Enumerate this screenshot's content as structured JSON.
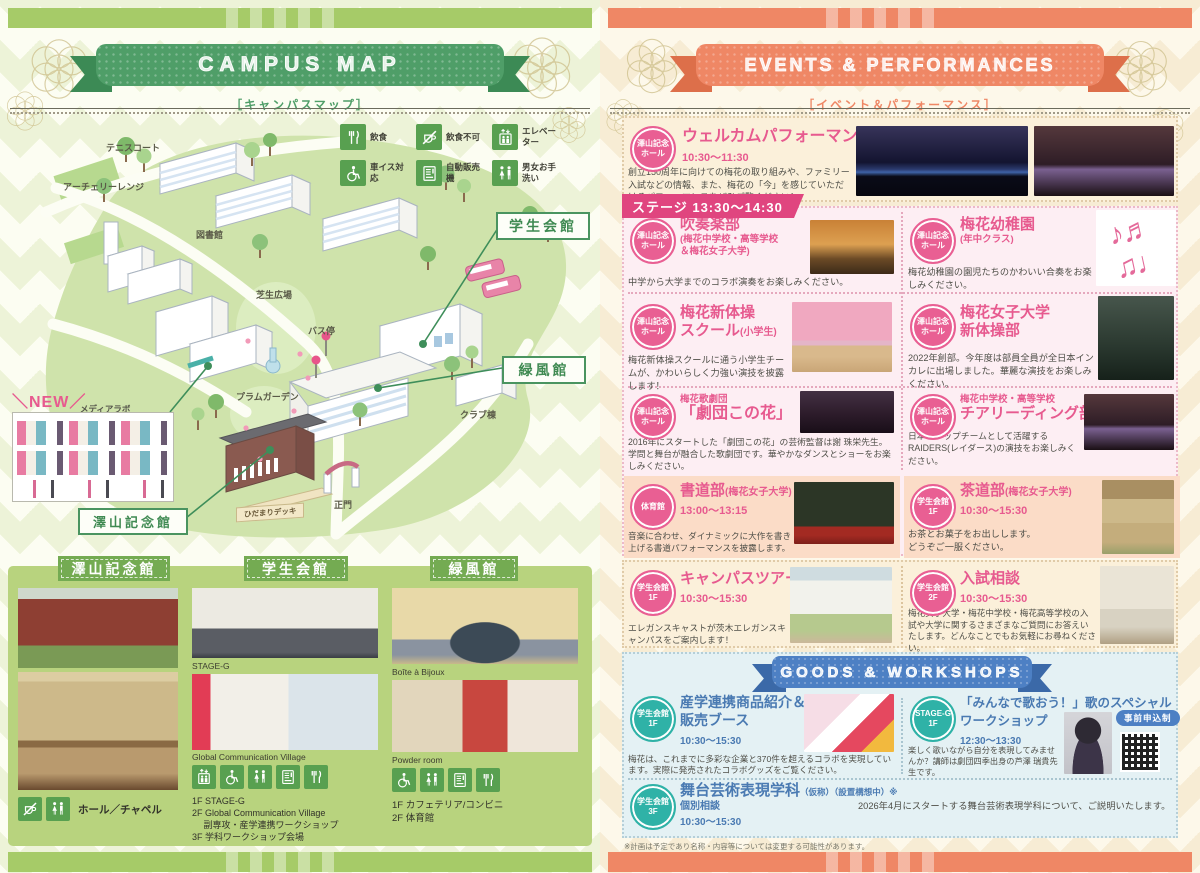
{
  "left_page": {
    "ribbon": {
      "title": "CAMPUS MAP",
      "subtitle": "［キャンパスマップ］"
    },
    "legend": {
      "items": [
        {
          "icon": "utensils-icon",
          "label": "飲食"
        },
        {
          "icon": "no-food-icon",
          "label": "飲食不可"
        },
        {
          "icon": "elevator-icon",
          "label": "エレベーター"
        },
        {
          "icon": "wheelchair-icon",
          "label": "車イス対応"
        },
        {
          "icon": "vending-icon",
          "label": "自動販売機"
        },
        {
          "icon": "restroom-icon",
          "label": "男女お手洗い"
        }
      ]
    },
    "map": {
      "labels": {
        "tennis_court": "テニスコート",
        "archery_range": "アーチェリーレンジ",
        "library": "図書館",
        "lawn_plaza": "芝生広場",
        "new_tag": "＼NEW／",
        "media_lab": "メディアラボ",
        "plum_garden": "プラムガーデン",
        "bus_stop": "バス停",
        "student_hall": "学生会館",
        "ryokufu_hall": "緑風館",
        "club_building": "クラブ棟",
        "main_gate": "正門",
        "hidamari_deck": "ひだまりデッキ",
        "sawayama_hall": "澤山記念館"
      }
    },
    "buildings": {
      "columns": [
        {
          "title": "澤山記念館",
          "facility": "ホール／チャペル",
          "icons": [
            "no-food-icon",
            "restroom-icon"
          ],
          "captions": [],
          "floors": []
        },
        {
          "title": "学生会館",
          "captions": [
            "STAGE-G",
            "Global Communication Village"
          ],
          "icons": [
            "elevator-icon",
            "wheelchair-icon",
            "restroom-icon",
            "vending-icon",
            "utensils-icon"
          ],
          "floors": [
            "1F STAGE-G",
            "2F Global Communication Village",
            "　 副専攻・産学連携ワークショップ",
            "3F 学科ワークショップ会場"
          ]
        },
        {
          "title": "緑風館",
          "captions": [
            "Boîte à Bijoux",
            "Powder room"
          ],
          "icons": [
            "wheelchair-icon",
            "restroom-icon",
            "vending-icon",
            "utensils-icon"
          ],
          "floors": [
            "1F カフェテリア/コンビニ",
            "2F 体育館"
          ]
        }
      ]
    }
  },
  "right_page": {
    "ribbon": {
      "title": "EVENTS & PERFORMANCES",
      "subtitle": "［イベント＆パフォーマンス］"
    },
    "welcome": {
      "venue1": "澤山記念",
      "venue2": "ホール",
      "title": "ウェルカムパフォーマンス",
      "time": "10:30～11:30",
      "desc": "創立150周年に向けての梅花の取り組みや、ファミリー入試などの情報、また、梅花の「今」を感じていただけるパフォーマンスをぜひご覧ください！"
    },
    "stage": {
      "banner": "ステージ 13:30～14:30",
      "events": [
        {
          "venue1": "澤山記念",
          "venue2": "ホール",
          "title": "吹奏楽部",
          "sub": "(梅花中学校・高等学校\n＆梅花女子大学)",
          "desc": "中学から大学までのコラボ演奏をお楽しみください。"
        },
        {
          "venue1": "澤山記念",
          "venue2": "ホール",
          "title": "梅花幼稚園",
          "sub": "(年中クラス)",
          "desc": "梅花幼稚園の園児たちのかわいい合奏をお楽しみください。"
        },
        {
          "venue1": "澤山記念",
          "venue2": "ホール",
          "title": "梅花新体操\nスクール",
          "sub": "(小学生)",
          "desc": "梅花新体操スクールに通う小学生チームが、かわいらしく力強い演技を披露します！"
        },
        {
          "venue1": "澤山記念",
          "venue2": "ホール",
          "title": "梅花女子大学\n新体操部",
          "desc": "2022年創部。今年度は部員全員が全日本インカレに出場しました。華麗な演技をお楽しみください。"
        },
        {
          "venue1": "澤山記念",
          "venue2": "ホール",
          "pre": "梅花歌劇団",
          "title": "「劇団この花」",
          "desc": "2016年にスタートした「劇団この花」の芸術監督は謝 珠栄先生。学問と舞台が融合した歌劇団です。華やかなダンスとショーをお楽しみください。"
        },
        {
          "venue1": "澤山記念",
          "venue2": "ホール",
          "pre": "梅花中学校・高等学校",
          "title": "チアリーディング部",
          "desc": "日本のトップチームとして活躍するRAIDERS(レイダース)の演技をお楽しみください。"
        },
        {
          "venue1": "体育館",
          "venue2": "",
          "title": "書道部",
          "sub": "(梅花女子大学)",
          "time": "13:00～13:15",
          "desc": "音楽に合わせ、ダイナミックに大作を書き上げる書道パフォーマンスを披露します。"
        },
        {
          "venue1": "学生会館",
          "venue2": "1F",
          "title": "茶道部",
          "sub": "(梅花女子大学)",
          "time": "10:30～15:30",
          "desc": "お茶とお菓子をお出しします。\nどうぞご一服ください。"
        }
      ]
    },
    "tours": [
      {
        "venue1": "学生会館",
        "venue2": "1F",
        "title": "キャンパスツアー",
        "time": "10:30～15:30",
        "desc": "エレガンスキャストが茨木エレガンスキャンパスをご案内します！"
      },
      {
        "venue1": "学生会館",
        "venue2": "2F",
        "title": "入試相談",
        "time": "10:30～15:30",
        "desc": "梅花女子大学・梅花中学校・梅花高等学校の入試や大学に関するさまざまなご質問にお答えいたします。どんなことでもお気軽にお尋ねください。"
      }
    ],
    "goods": {
      "ribbon_title": "GOODS & WORKSHOPS",
      "events": [
        {
          "venue1": "学生会館",
          "venue2": "1F",
          "title": "産学連携商品紹介＆\n販売ブース",
          "time": "10:30～15:30",
          "desc": "梅花は、これまでに多彩な企業と370件を超えるコラボを実現しています。実際に発売されたコラボグッズをご覧ください。"
        },
        {
          "venue1": "STAGE-G",
          "venue2": "1F",
          "title": "「みんなで歌おう！」歌のスペシャル\nワークショップ",
          "time": "12:30～13:30",
          "badge": "事前申込制",
          "desc": "楽しく歌いながら自分を表現してみませんか？講師は劇団四季出身の芦澤 瑞貴先生です。"
        }
      ],
      "bottom": {
        "venue1": "学生会館",
        "venue2": "3F",
        "title": "舞台芸術表現学科",
        "title_note": "（仮称）（設置構想中）※",
        "line2": "個別相談",
        "time": "10:30～15:30",
        "desc": "2026年4月にスタートする舞台芸術表現学科について、ご説明いたします。"
      }
    },
    "note": "※計画は予定であり名称・内容等については変更する可能性があります。"
  }
}
